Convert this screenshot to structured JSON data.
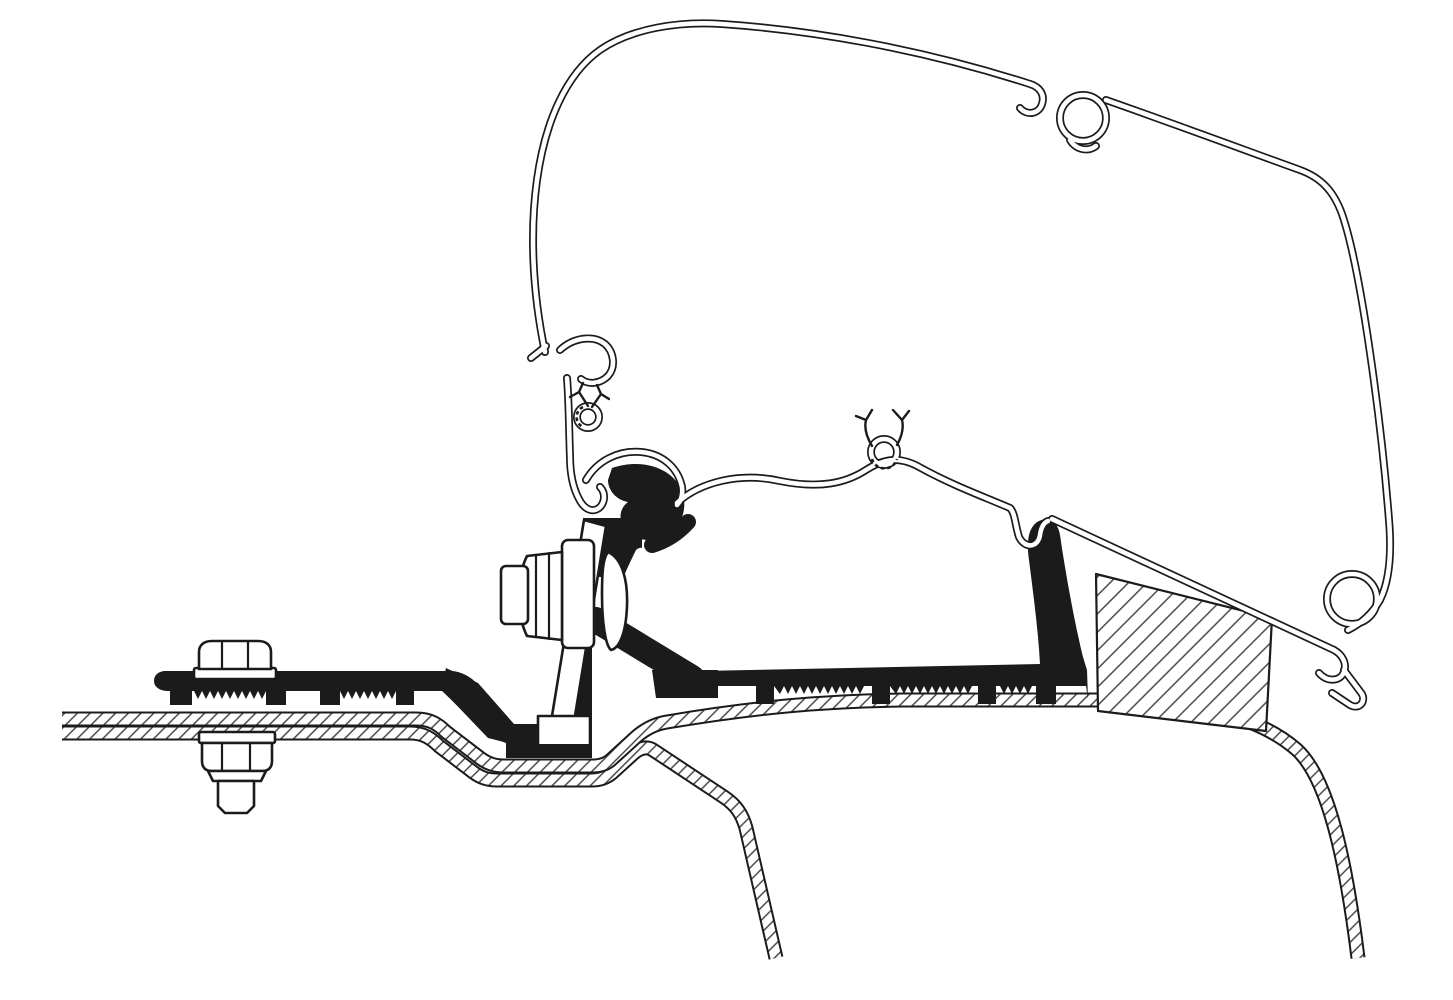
{
  "figure": {
    "title": "Awning roof adapter cross-section",
    "description": "Technical line-art cross-section showing an awning cassette profile hooked onto a solid adapter bracket that is bolted through a van roof; hatched areas are cut sheet metal and a foam packer block.",
    "parts": [
      {
        "id": "awning-case-profile",
        "label": "Awning cassette outer profile"
      },
      {
        "id": "awning-mounting-rail",
        "label": "Awning mounting rail profile"
      },
      {
        "id": "adapter-bracket",
        "label": "Adapter bracket (solid section)"
      },
      {
        "id": "rail-flange-plate",
        "label": "Clamped rail flange with serrated foot"
      },
      {
        "id": "clamp-bolt",
        "label": "Horizontal clamp bolt with washer"
      },
      {
        "id": "roof-mounting-bolt",
        "label": "Vertical roof mounting bolt with nut and stud"
      },
      {
        "id": "roof-outer-sheet",
        "label": "Vehicle roof outer sheet (hatched)"
      },
      {
        "id": "roof-inner-sheet",
        "label": "Vehicle roof inner sheet (hatched)"
      },
      {
        "id": "foam-packer-block",
        "label": "Foam packer block (hatched)"
      }
    ]
  },
  "colors": {
    "ink": "#1b1b1b",
    "paper": "#ffffff",
    "hatch_line": "#3d3d3d",
    "background": "#ffffff"
  }
}
